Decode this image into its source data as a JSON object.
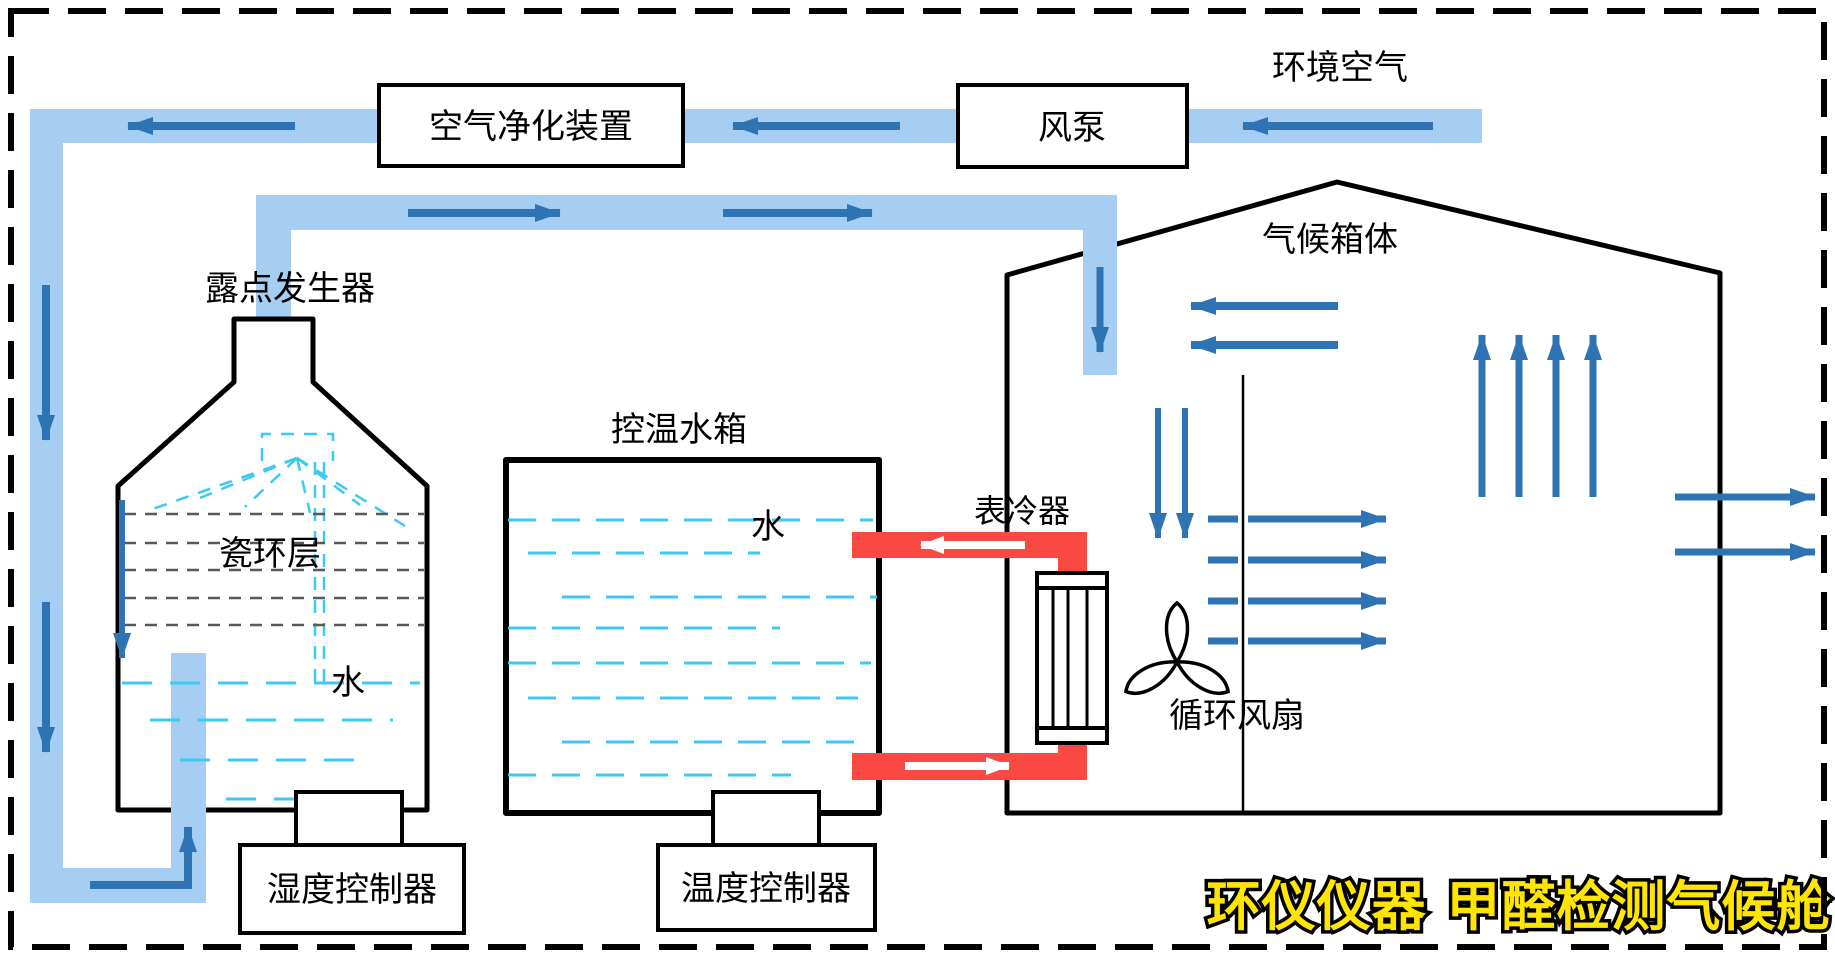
{
  "diagram": {
    "title": "甲醛检测气候舱系统原理图",
    "labels": {
      "ambient_air": "环境空气",
      "air_pump": "风泵",
      "air_purifier": "空气净化装置",
      "dew_point_generator": "露点发生器",
      "ceramic_ring_layer": "瓷环层",
      "dew_generator_water": "水",
      "temp_water_tank": "控温水箱",
      "tank_water": "水",
      "surface_cooler": "表冷器",
      "climate_chamber": "气候箱体",
      "circulation_fan": "循环风扇",
      "humidity_controller": "湿度控制器",
      "temperature_controller": "温度控制器"
    },
    "watermark": "环仪仪器 甲醛检测气候舱",
    "colors": {
      "pipe_blue": "#A6CDF2",
      "arrow_blue": "#2E74B5",
      "water_cyan": "#3EC9F5",
      "ceramic_gray": "#595959",
      "coolant_red": "#FA4843",
      "watermark_yellow": "#FFE500",
      "line_black": "#000000",
      "background": "#FFFFFF"
    }
  }
}
